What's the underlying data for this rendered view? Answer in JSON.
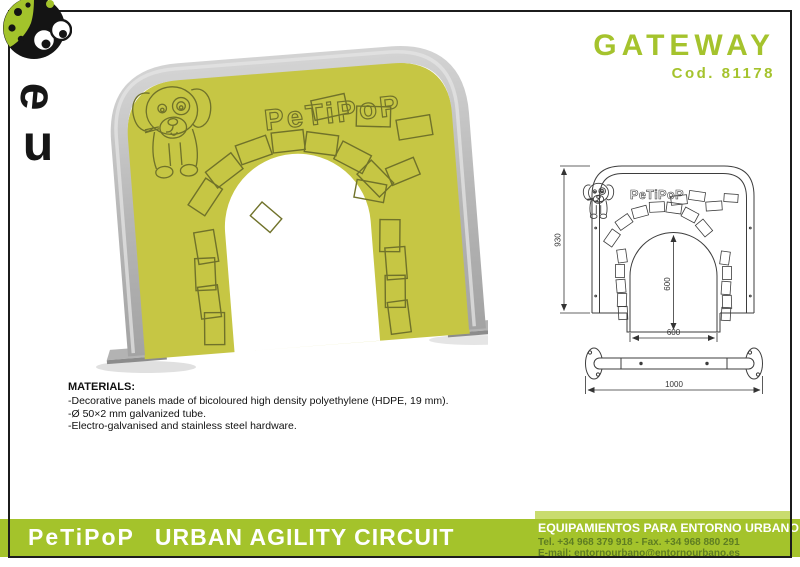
{
  "header": {
    "title": "GATEWAY",
    "code": "Cod. 81178"
  },
  "logo": {
    "letter_e": "e",
    "letter_u": "u"
  },
  "photo": {
    "brand": "PeTiPoP"
  },
  "drawing": {
    "brand": "PeTiPoP",
    "dims": {
      "height": "930",
      "arch_height": "600",
      "arch_width": "600",
      "base_length": "1000"
    }
  },
  "materials": {
    "heading": "MATERIALS:",
    "items": [
      "-Decorative panels made of bicoloured high density polyethylene (HDPE, 19 mm).",
      "-Ø 50×2 mm galvanized tube.",
      "-Electro-galvanised and stainless steel hardware."
    ]
  },
  "footer": {
    "brand": "PeTiPoP",
    "series": "URBAN AGILITY CIRCUIT",
    "company": "EQUIPAMIENTOS PARA ENTORNO URBANO",
    "tel_fax": "Tel. +34 968 379 918 - Fax. +34 968 880 291",
    "email": "E-mail: entornourbano@entornourbano.es"
  },
  "colors": {
    "accent_green": "#a5c32d",
    "footer_bar_green": "#a4c32b",
    "panel_yellow_green": "#c6c644",
    "engraving_olive": "#70722a",
    "tube_grey": "#b7b7b7"
  }
}
